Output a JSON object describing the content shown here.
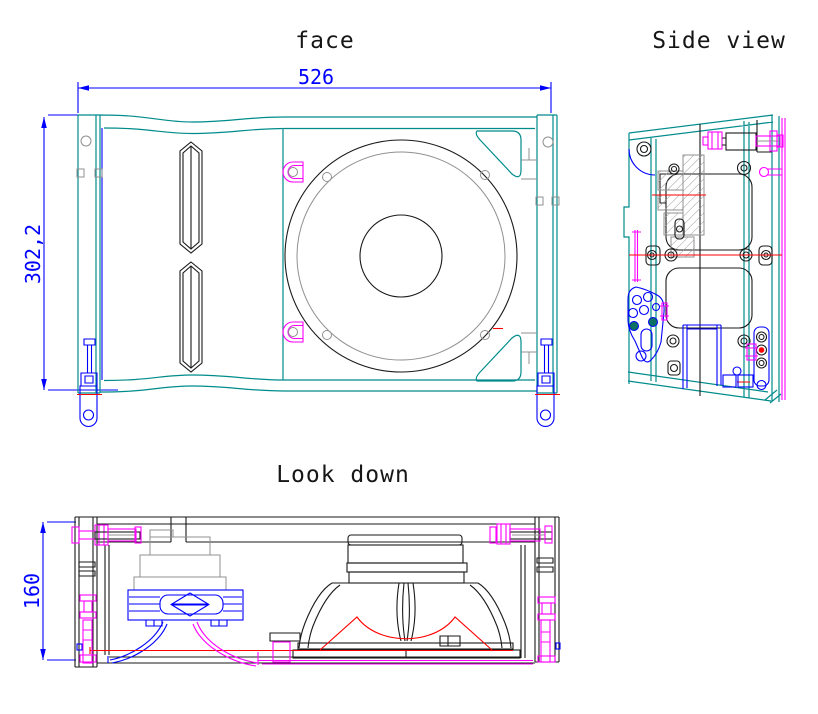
{
  "titles": {
    "face": "face",
    "side": "Side view",
    "top": "Look down"
  },
  "dimensions": {
    "face_width": "526",
    "face_height": "302,2",
    "depth": "160"
  },
  "palette": {
    "background": "#FFFFFF",
    "outline_teal": "#008B8B",
    "dimension_blue": "#0000FF",
    "hardware_magenta": "#FF00FF",
    "centerline_red": "#FF0000",
    "detail_black": "#1A1A1A",
    "detail_gray": "#909090",
    "fill_teal_dark": "#0E6F63"
  }
}
